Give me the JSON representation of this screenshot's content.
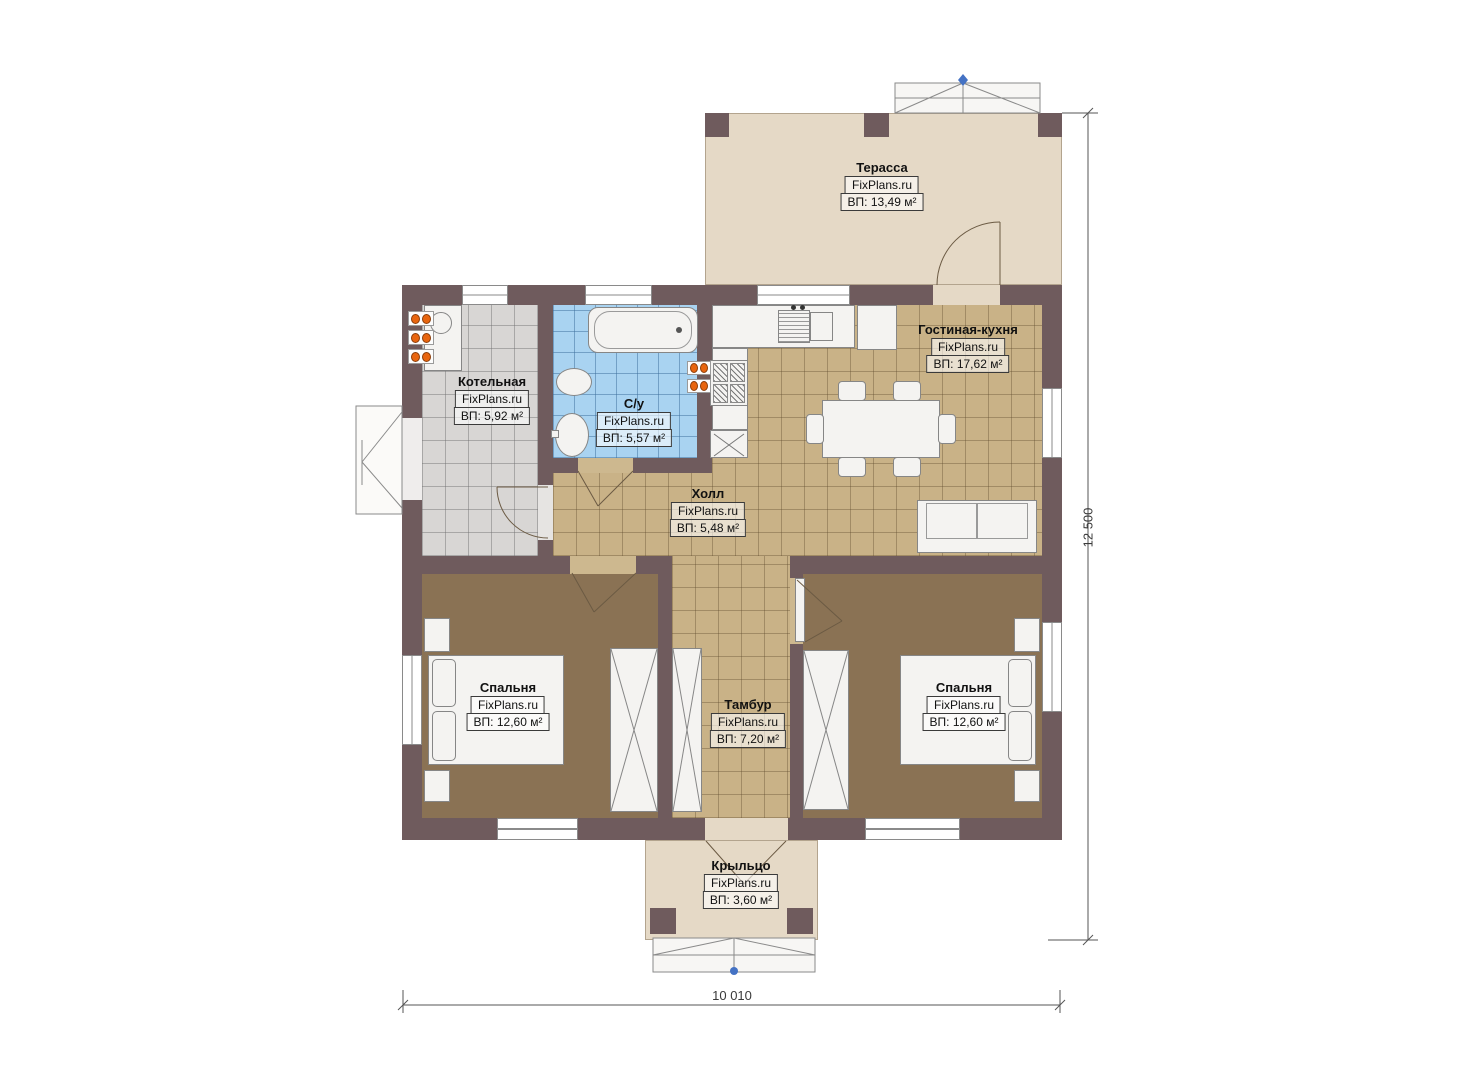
{
  "brand": "FixPlans.ru",
  "rooms": {
    "terrace": {
      "name": "Терасса",
      "area": "ВП: 13,49 м²"
    },
    "living_kitchen": {
      "name": "Гостиная-кухня",
      "area": "ВП: 17,62 м²"
    },
    "boiler": {
      "name": "Котельная",
      "area": "ВП: 5,92 м²"
    },
    "bathroom": {
      "name": "С/у",
      "area": "ВП: 5,57 м²"
    },
    "hall": {
      "name": "Холл",
      "area": "ВП: 5,48 м²"
    },
    "bedroom_left": {
      "name": "Спальня",
      "area": "ВП: 12,60 м²"
    },
    "bedroom_right": {
      "name": "Спальня",
      "area": "ВП: 12,60 м²"
    },
    "vestibule": {
      "name": "Тамбур",
      "area": "ВП: 7,20 м²"
    },
    "porch": {
      "name": "Крыльцо",
      "area": "ВП: 3,60 м²"
    }
  },
  "dimensions": {
    "vertical": "12 500",
    "horizontal": "10 010"
  },
  "colors": {
    "wall": "#6f5b5d",
    "terrace_floor": "#e5d9c6",
    "tile_tan": "#c9b287",
    "tile_blue": "#a9d3f1",
    "tile_gray": "#d8d6d4",
    "bedroom_floor": "#8a7254",
    "radiator": "#e8650f",
    "marker": "#4472c4"
  }
}
